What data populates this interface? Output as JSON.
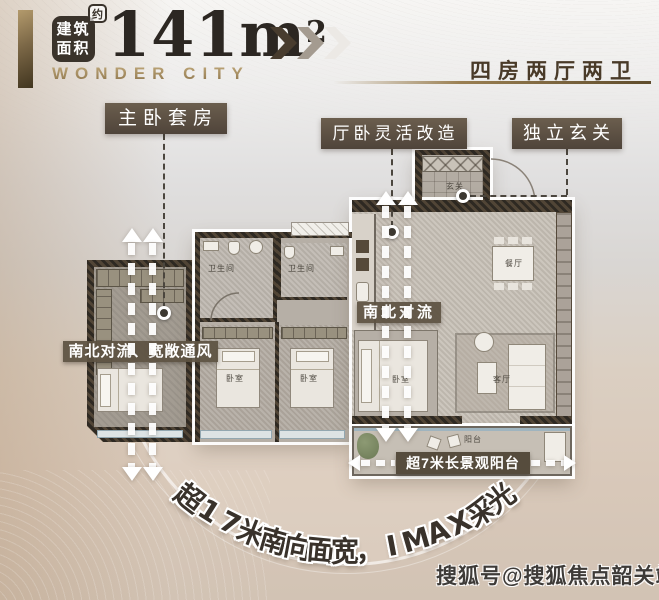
{
  "header": {
    "badge_line1": "建筑",
    "badge_line2": "面积",
    "approx": "约",
    "area_value": "141",
    "area_unit": "m",
    "area_exponent": "2",
    "brand": "WONDER CITY",
    "layout_spec": "四房两厅两卫"
  },
  "callouts": {
    "master_suite": "主卧套房",
    "flexible_room": "厅卧灵活改造",
    "entry_hall": "独立玄关",
    "ventilation_wide": "南北对流、宽敞通风",
    "ventilation": "南北对流",
    "balcony_feature": "超7米长景观阳台"
  },
  "rooms": {
    "bathroom_1": "卫生间",
    "bathroom_2": "卫生间",
    "bedroom_a": "卧室",
    "bedroom_b": "卧室",
    "bedroom_c": "卧室",
    "entry": "玄关",
    "dining": "餐厅",
    "living": "客厅",
    "balcony": "阳台"
  },
  "tagline": "超17米南向面宽，IMAX采光",
  "watermark": "搜狐号@搜狐焦点韶关站",
  "colors": {
    "accent_gold": "#9a7f52",
    "label_bg": "#5a4e3f",
    "wall_dark": "#38322a",
    "text_dark": "#332d26",
    "arrow_white": "#ffffff",
    "bay_window_blue": "#93a7b0"
  }
}
